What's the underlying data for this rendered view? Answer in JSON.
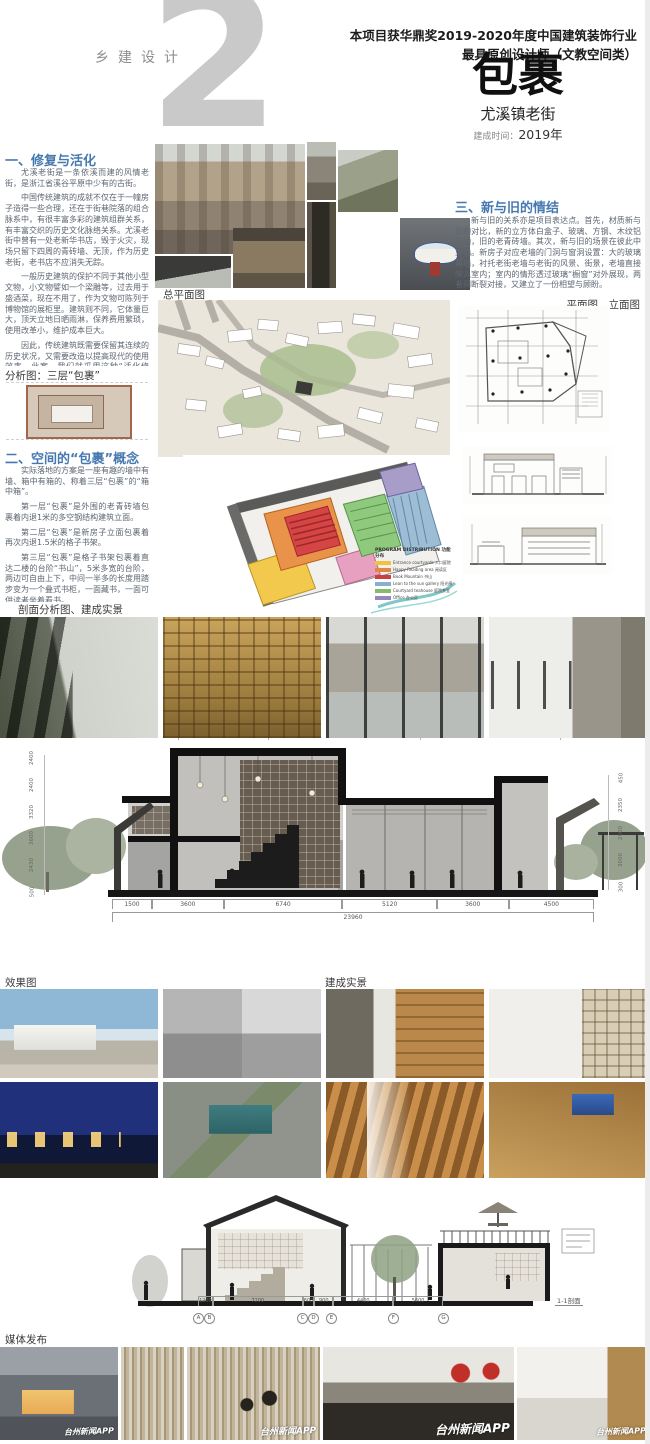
{
  "header": {
    "series_label": "乡建设计",
    "big_number": "2",
    "award_line1": "本项目获华鼎奖2019-2020年度中国建筑装饰行业",
    "award_line2": "最具原创设计师（文教空间类）",
    "title": "包裹",
    "subtitle": "尤溪镇老街",
    "built_time_label": "建成时间：",
    "built_time_value": "2019年"
  },
  "sections": {
    "s1": {
      "heading": "一、修复与活化",
      "p": [
        "尤溪老街是一条依溪而建的风情老街，是浙江省溪谷平原中少有的古街。",
        "中国传统建筑的成就不仅在于一幢房子造得一些合理，还在于街巷院落的组合脉系中，有很丰富多彩的建筑组群关系，有丰富交织的历史文化脉络关系。尤溪老街中曾有一处老新华书店，毁于火灾，现场只留下四周的青砖墙、无顶，作为历史老街，老书店不应消失无踪。",
        "一般历史建筑的保护不同于其他小型文物，小文物譬如一个梁雕等，过去用于盛酒菜，现在不用了，作为文物可陈列于博物馆的展柜里。建筑则不同，它体量巨大，顶天立地日晒雨淋，保养费用繁琐，使用改革小，维护成本巨大。",
        "因此，传统建筑既需要保留其连续的历史状况，又需要改造以提高现代的使用效率。此案，我们就采用这种“活化修复”法，保留场地历史遗存——四周的老青砖墙，墙内侧采用钢结构建筑，新建空间作为乡镇图书馆尤溪分馆，成为一处公共阅读场所、学习的场地，也作为小型讲座、小型聚会宴会活动的场所。"
      ]
    },
    "s2": {
      "heading": "二、空间的“包裹”概念",
      "p": [
        "实际落地的方案是一座有趣的墙中有墙、箱中有箱的、称着三层“包裹”的“箱中箱”。",
        "第一层“包裹”是外围的老青砖墙包裹着内退1米的多空钢结构建筑立面。",
        "第二层“包裹”是新房子立面包裹着再次内退1.5米的格子书架。",
        "第三层“包裹”是格子书架包裹着直达二楼的台阶“书山”，5米多宽的台阶，两边可自由上下，中间一半多的长度用踏步变为一个叠式书柜，一面藏书，一面可供读者坐着看书。",
        "三层包裹带出了空间与速度，形成了空间的围透与层叠，似乎承载随感悟围合，塑造了场所的流动与静谧、现代与质朴、直白与含蓄。"
      ]
    },
    "s3": {
      "heading": "三、新与旧的情结",
      "p": [
        "新与旧的关系亦是项目表达点。首先，材质新与旧的对比，新的立方体白盒子、玻璃、方钢、木纹铝方通，旧的老青砖墙。其次，新与旧的场景在彼此中穿插。新房子对应老墙的门洞与窗洞设置：大的玻璃幕墙，衬托老街老墙与老街的风景、街景，老墙直接映入室内；室内的情形透过玻璃“橱窗”对外展现，两者间断裂对接，又建立了一份相望与顾盼。"
      ]
    }
  },
  "labels": {
    "analysis": "分析图：三层“包裹”",
    "site_plan": "总平面图",
    "plan_elev": "平面图、立面图",
    "section_row": "剖面分析图、建成实景",
    "render": "效果图",
    "built": "建成实景",
    "media": "媒体发布",
    "section_ref": "1-1剖面"
  },
  "program_legend": {
    "title": "PROGRAM DISTRIBUTION 功能分布",
    "items": [
      {
        "label": "Entrance courtyards 入口庭院",
        "color": "#f0c240"
      },
      {
        "label": "Happy Reading area 阅读区",
        "color": "#e08840"
      },
      {
        "label": "Book Mountain 书山",
        "color": "#cc4040"
      },
      {
        "label": "Lean to the sun gallery 阳光廊",
        "color": "#88b0cc"
      },
      {
        "label": "Courtyard teahouse 庭院茶室",
        "color": "#84bc6c"
      },
      {
        "label": "Office 办公区",
        "color": "#9488bc"
      }
    ]
  },
  "dims1": {
    "bottom": [
      "1500",
      "3600",
      "6740",
      "5120",
      "3600",
      "4500"
    ],
    "total": "23960",
    "left": [
      "2400",
      "2400",
      "3320",
      "3600",
      "2430",
      "500"
    ],
    "right": [
      "450",
      "2350",
      "2000",
      "3600",
      "300"
    ]
  },
  "dims2": {
    "bottom": [
      "1200",
      "7200",
      "600",
      "900",
      "4400",
      "5600"
    ],
    "bubbles": [
      "A",
      "B",
      "C",
      "D",
      "E",
      "F",
      "G"
    ]
  },
  "media": {
    "watermark": "台州新闻APP"
  },
  "colors": {
    "heading_blue": "#4678b0",
    "big_number_gray": "#c9c9c9"
  }
}
